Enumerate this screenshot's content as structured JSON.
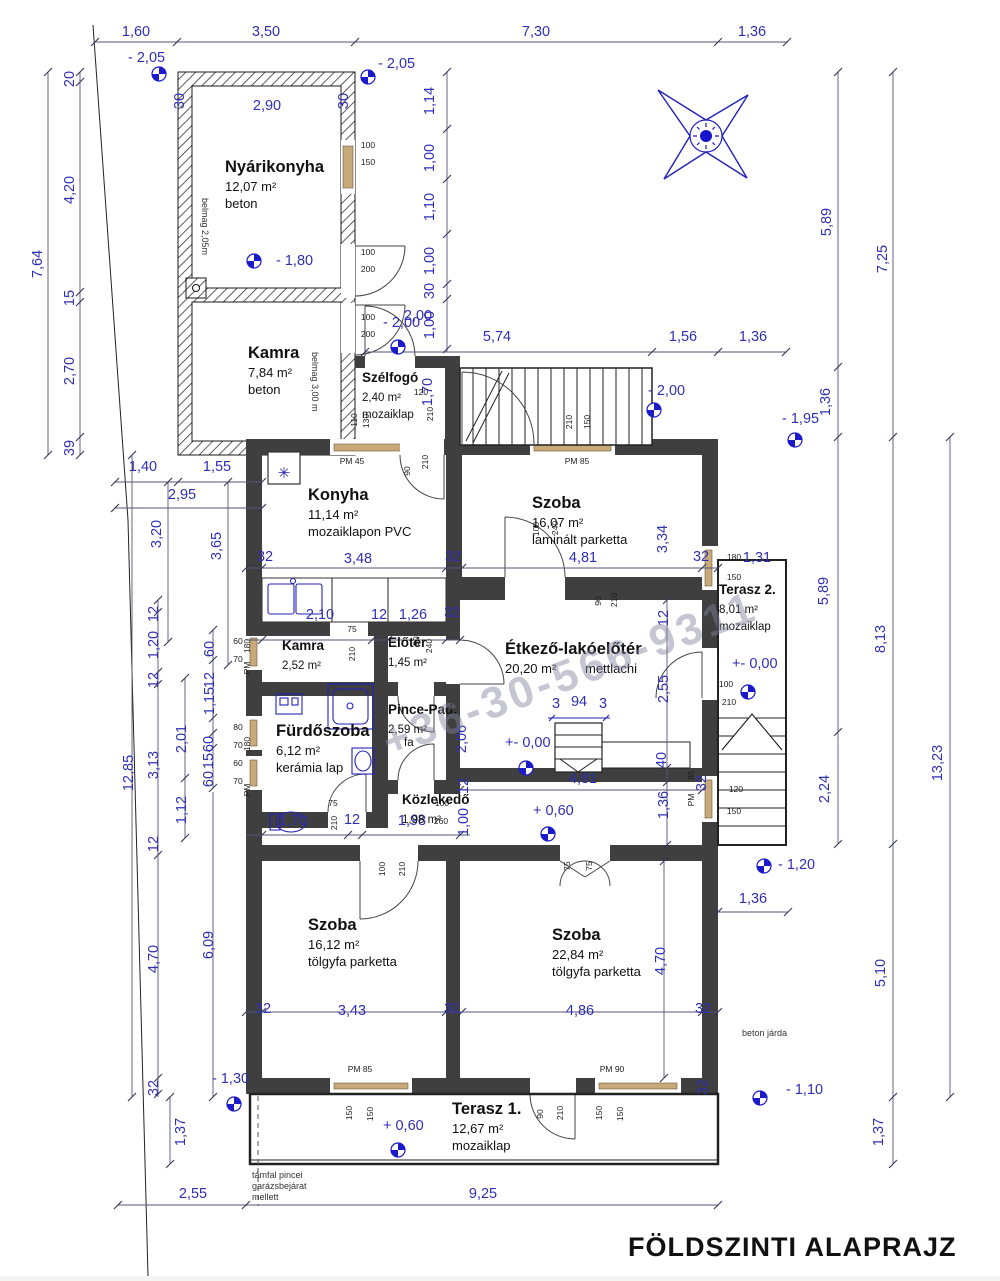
{
  "title": "FÖLDSZINTI ALAPRAJZ",
  "watermark": "+36-30-566-9311",
  "colors": {
    "dimension_text": "#2f2fb3",
    "wall_fill": "#3f3f3f",
    "window_fill": "#c8a97a",
    "fixture_blue": "#2222bb"
  },
  "rooms": [
    {
      "name": "Nyárikonyha",
      "area": "12,07 m²",
      "floor": "beton",
      "x": 225,
      "y": 172
    },
    {
      "name": "Kamra",
      "area": "7,84 m²",
      "floor": "beton",
      "x": 248,
      "y": 358
    },
    {
      "name": "Szélfogó",
      "area": "2,40 m²",
      "floor": "mozaiklap",
      "x": 362,
      "y": 382,
      "sm": 1
    },
    {
      "name": "Konyha",
      "area": "11,14 m²",
      "floor": "mozaiklapon PVC",
      "x": 308,
      "y": 500
    },
    {
      "name": "Szoba",
      "area": "16,07 m²",
      "floor": "laminált parketta",
      "x": 532,
      "y": 508
    },
    {
      "name": "Kamra",
      "area": "2,52 m²",
      "floor": "",
      "x": 282,
      "y": 650,
      "sm": 1
    },
    {
      "name": "Előtér",
      "area": "1,45 m²",
      "floor": "",
      "x": 388,
      "y": 647,
      "sm": 1
    },
    {
      "name": "Étkező-lakóelőtér",
      "area": "20,20 m²",
      "floor": "mettlachi",
      "x": 505,
      "y": 654,
      "f2": [
        585,
        673
      ]
    },
    {
      "name": "Fürdőszoba",
      "area": "6,12 m²",
      "floor": "kerámia lap",
      "x": 276,
      "y": 736
    },
    {
      "name": "Pince-Pad.",
      "area": "2,59 m²",
      "floor": "fa",
      "x": 388,
      "y": 714,
      "sm": 1,
      "f2": [
        404,
        746
      ]
    },
    {
      "name": "Közlekedő",
      "area": "1,98 m²",
      "floor": "",
      "x": 402,
      "y": 804,
      "sm": 1
    },
    {
      "name": "Szoba",
      "area": "16,12 m²",
      "floor": "tölgyfa parketta",
      "x": 308,
      "y": 930
    },
    {
      "name": "Szoba",
      "area": "22,84 m²",
      "floor": "tölgyfa parketta",
      "x": 552,
      "y": 940
    },
    {
      "name": "Terasz 1.",
      "area": "12,67 m²",
      "floor": "mozaiklap",
      "x": 452,
      "y": 1114
    },
    {
      "name": "Terasz 2.",
      "area": "8,01 m²",
      "floor": "mozaiklap",
      "x": 719,
      "y": 594,
      "sm": 1
    }
  ],
  "dims": [
    {
      "t": "1,60",
      "x": 136,
      "y": 36
    },
    {
      "t": "3,50",
      "x": 266,
      "y": 36
    },
    {
      "t": "7,30",
      "x": 536,
      "y": 36
    },
    {
      "t": "1,36",
      "x": 752,
      "y": 36
    },
    {
      "t": "7,64",
      "x": 42,
      "y": 264,
      "r": 1
    },
    {
      "t": "20",
      "x": 74,
      "y": 79,
      "r": 1
    },
    {
      "t": "4,20",
      "x": 74,
      "y": 190,
      "r": 1
    },
    {
      "t": "15",
      "x": 74,
      "y": 298,
      "r": 1
    },
    {
      "t": "2,70",
      "x": 74,
      "y": 371,
      "r": 1
    },
    {
      "t": "39",
      "x": 74,
      "y": 448,
      "r": 1
    },
    {
      "t": "2,90",
      "x": 267,
      "y": 110
    },
    {
      "t": "30",
      "x": 184,
      "y": 101,
      "r": 1
    },
    {
      "t": "30",
      "x": 348,
      "y": 101,
      "r": 1
    },
    {
      "t": "1,14",
      "x": 434,
      "y": 101,
      "r": 1
    },
    {
      "t": "1,00",
      "x": 434,
      "y": 158,
      "r": 1
    },
    {
      "t": "1,10",
      "x": 434,
      "y": 207,
      "r": 1
    },
    {
      "t": "1,00",
      "x": 434,
      "y": 261,
      "r": 1
    },
    {
      "t": "30",
      "x": 434,
      "y": 291,
      "r": 1
    },
    {
      "t": "1,00",
      "x": 434,
      "y": 325,
      "r": 1
    },
    {
      "t": "1,70",
      "x": 432,
      "y": 392,
      "r": 1
    },
    {
      "t": "2,00",
      "x": 418,
      "y": 320
    },
    {
      "t": "5,74",
      "x": 497,
      "y": 341
    },
    {
      "t": "1,56",
      "x": 683,
      "y": 341
    },
    {
      "t": "1,36",
      "x": 753,
      "y": 341
    },
    {
      "t": "1,40",
      "x": 143,
      "y": 471
    },
    {
      "t": "1,55",
      "x": 217,
      "y": 471
    },
    {
      "t": "2,95",
      "x": 182,
      "y": 499
    },
    {
      "t": "3,20",
      "x": 161,
      "y": 534,
      "r": 1
    },
    {
      "t": "3,65",
      "x": 221,
      "y": 546,
      "r": 1
    },
    {
      "t": "32",
      "x": 265,
      "y": 561
    },
    {
      "t": "3,48",
      "x": 358,
      "y": 563
    },
    {
      "t": "32",
      "x": 453,
      "y": 561
    },
    {
      "t": "4,81",
      "x": 583,
      "y": 562
    },
    {
      "t": "32",
      "x": 701,
      "y": 561
    },
    {
      "t": "3,34",
      "x": 667,
      "y": 539,
      "r": 1
    },
    {
      "t": "1,31",
      "x": 757,
      "y": 562
    },
    {
      "t": "5,89",
      "x": 831,
      "y": 222,
      "r": 1
    },
    {
      "t": "7,25",
      "x": 887,
      "y": 259,
      "r": 1
    },
    {
      "t": "1,36",
      "x": 830,
      "y": 402,
      "r": 1
    },
    {
      "t": "5,89",
      "x": 828,
      "y": 591,
      "r": 1
    },
    {
      "t": "8,13",
      "x": 885,
      "y": 639,
      "r": 1
    },
    {
      "t": "13,23",
      "x": 942,
      "y": 763,
      "r": 1
    },
    {
      "t": "2,24",
      "x": 829,
      "y": 789,
      "r": 1
    },
    {
      "t": "5,10",
      "x": 885,
      "y": 973,
      "r": 1
    },
    {
      "t": "1,37",
      "x": 883,
      "y": 1132,
      "r": 1
    },
    {
      "t": "2,10",
      "x": 320,
      "y": 619
    },
    {
      "t": "12",
      "x": 379,
      "y": 619
    },
    {
      "t": "1,26",
      "x": 413,
      "y": 619
    },
    {
      "t": "32",
      "x": 452,
      "y": 617
    },
    {
      "t": "2,55",
      "x": 668,
      "y": 689,
      "r": 1
    },
    {
      "t": "3",
      "x": 556,
      "y": 708
    },
    {
      "t": "94",
      "x": 579,
      "y": 706
    },
    {
      "t": "3",
      "x": 603,
      "y": 708
    },
    {
      "t": "4,81",
      "x": 583,
      "y": 783
    },
    {
      "t": "40",
      "x": 666,
      "y": 760,
      "r": 1
    },
    {
      "t": "1,36",
      "x": 668,
      "y": 805,
      "r": 1
    },
    {
      "t": "1,70",
      "x": 293,
      "y": 825
    },
    {
      "t": "12",
      "x": 352,
      "y": 824
    },
    {
      "t": "1,98",
      "x": 412,
      "y": 825
    },
    {
      "t": "12",
      "x": 158,
      "y": 614,
      "r": 1
    },
    {
      "t": "1,20",
      "x": 158,
      "y": 645,
      "r": 1
    },
    {
      "t": "12",
      "x": 158,
      "y": 680,
      "r": 1
    },
    {
      "t": "60",
      "x": 214,
      "y": 649,
      "r": 1
    },
    {
      "t": "1,15",
      "x": 214,
      "y": 701,
      "r": 1
    },
    {
      "t": "12",
      "x": 214,
      "y": 680,
      "r": 1
    },
    {
      "t": "2,01",
      "x": 186,
      "y": 739,
      "r": 1
    },
    {
      "t": "60",
      "x": 213,
      "y": 744,
      "r": 1
    },
    {
      "t": "15",
      "x": 213,
      "y": 761,
      "r": 1
    },
    {
      "t": "60",
      "x": 213,
      "y": 779,
      "r": 1
    },
    {
      "t": "1,12",
      "x": 186,
      "y": 810,
      "r": 1
    },
    {
      "t": "12",
      "x": 158,
      "y": 844,
      "r": 1
    },
    {
      "t": "12,85",
      "x": 133,
      "y": 773,
      "r": 1
    },
    {
      "t": "3,13",
      "x": 158,
      "y": 765,
      "r": 1
    },
    {
      "t": "2,06",
      "x": 466,
      "y": 739,
      "r": 1
    },
    {
      "t": "1,00",
      "x": 468,
      "y": 822,
      "r": 1
    },
    {
      "t": "12",
      "x": 468,
      "y": 786,
      "r": 1
    },
    {
      "t": "6,09",
      "x": 213,
      "y": 945,
      "r": 1
    },
    {
      "t": "4,70",
      "x": 158,
      "y": 959,
      "r": 1
    },
    {
      "t": "4,70",
      "x": 665,
      "y": 961,
      "r": 1
    },
    {
      "t": "32",
      "x": 158,
      "y": 1088,
      "r": 1
    },
    {
      "t": "1,37",
      "x": 185,
      "y": 1132,
      "r": 1
    },
    {
      "t": "2,55",
      "x": 193,
      "y": 1198
    },
    {
      "t": "3,43",
      "x": 352,
      "y": 1015
    },
    {
      "t": "32",
      "x": 263,
      "y": 1013
    },
    {
      "t": "32",
      "x": 452,
      "y": 1013
    },
    {
      "t": "4,86",
      "x": 580,
      "y": 1015
    },
    {
      "t": "32",
      "x": 703,
      "y": 1013
    },
    {
      "t": "9,25",
      "x": 483,
      "y": 1198
    },
    {
      "t": "1,36",
      "x": 753,
      "y": 903
    },
    {
      "t": "32",
      "x": 707,
      "y": 1087,
      "r": 1
    },
    {
      "t": "32",
      "x": 706,
      "y": 783,
      "r": 1
    },
    {
      "t": "12",
      "x": 668,
      "y": 618,
      "r": 1
    }
  ],
  "small_labels": [
    {
      "t": "100",
      "x": 368,
      "y": 148
    },
    {
      "t": "150",
      "x": 368,
      "y": 165
    },
    {
      "t": "100",
      "x": 368,
      "y": 255
    },
    {
      "t": "200",
      "x": 368,
      "y": 272
    },
    {
      "t": "100",
      "x": 368,
      "y": 320
    },
    {
      "t": "200",
      "x": 368,
      "y": 337
    },
    {
      "t": "PM  45",
      "x": 352,
      "y": 464
    },
    {
      "t": "PM  85",
      "x": 577,
      "y": 464
    },
    {
      "t": "210",
      "x": 572,
      "y": 422,
      "r": 1
    },
    {
      "t": "150",
      "x": 590,
      "y": 422,
      "r": 1
    },
    {
      "t": "120",
      "x": 421,
      "y": 395
    },
    {
      "t": "210",
      "x": 433,
      "y": 414,
      "r": 1
    },
    {
      "t": "110",
      "x": 357,
      "y": 420,
      "r": 1
    },
    {
      "t": "130",
      "x": 369,
      "y": 421,
      "r": 1
    },
    {
      "t": "90",
      "x": 410,
      "y": 471,
      "r": 1
    },
    {
      "t": "210",
      "x": 428,
      "y": 462,
      "r": 1
    },
    {
      "t": "100",
      "x": 539,
      "y": 529,
      "r": 1
    },
    {
      "t": "240",
      "x": 558,
      "y": 528,
      "r": 1
    },
    {
      "t": "75",
      "x": 352,
      "y": 632
    },
    {
      "t": "210",
      "x": 355,
      "y": 654,
      "r": 1
    },
    {
      "t": "90",
      "x": 419,
      "y": 641,
      "r": 1
    },
    {
      "t": "240",
      "x": 432,
      "y": 646,
      "r": 1
    },
    {
      "t": "60",
      "x": 238,
      "y": 644
    },
    {
      "t": "70",
      "x": 238,
      "y": 662
    },
    {
      "t": "80",
      "x": 238,
      "y": 730
    },
    {
      "t": "70",
      "x": 238,
      "y": 748
    },
    {
      "t": "60",
      "x": 238,
      "y": 766
    },
    {
      "t": "70",
      "x": 238,
      "y": 784
    },
    {
      "t": "180",
      "x": 250,
      "y": 646,
      "r": 1
    },
    {
      "t": "PM",
      "x": 250,
      "y": 668,
      "r": 1
    },
    {
      "t": "180",
      "x": 250,
      "y": 744,
      "r": 1
    },
    {
      "t": "PM",
      "x": 250,
      "y": 790,
      "r": 1
    },
    {
      "t": "75",
      "x": 333,
      "y": 806
    },
    {
      "t": "210",
      "x": 337,
      "y": 823,
      "r": 1
    },
    {
      "t": "100",
      "x": 442,
      "y": 806
    },
    {
      "t": "260",
      "x": 441,
      "y": 824
    },
    {
      "t": "90",
      "x": 601,
      "y": 601,
      "r": 1
    },
    {
      "t": "210",
      "x": 617,
      "y": 600,
      "r": 1
    },
    {
      "t": "100",
      "x": 726,
      "y": 687
    },
    {
      "t": "210",
      "x": 729,
      "y": 705
    },
    {
      "t": "180",
      "x": 734,
      "y": 560
    },
    {
      "t": "150",
      "x": 734,
      "y": 580
    },
    {
      "t": "120",
      "x": 736,
      "y": 792
    },
    {
      "t": "150",
      "x": 734,
      "y": 814
    },
    {
      "t": "85",
      "x": 694,
      "y": 775,
      "r": 1
    },
    {
      "t": "PM",
      "x": 694,
      "y": 800,
      "r": 1
    },
    {
      "t": "PM  85",
      "x": 360,
      "y": 1072
    },
    {
      "t": "PM  90",
      "x": 612,
      "y": 1072
    },
    {
      "t": "150",
      "x": 352,
      "y": 1113,
      "r": 1
    },
    {
      "t": "150",
      "x": 373,
      "y": 1114,
      "r": 1
    },
    {
      "t": "90",
      "x": 543,
      "y": 1114,
      "r": 1
    },
    {
      "t": "210",
      "x": 563,
      "y": 1113,
      "r": 1
    },
    {
      "t": "150",
      "x": 602,
      "y": 1113,
      "r": 1
    },
    {
      "t": "150",
      "x": 623,
      "y": 1114,
      "r": 1
    },
    {
      "t": "100",
      "x": 385,
      "y": 869,
      "r": 1
    },
    {
      "t": "210",
      "x": 405,
      "y": 869,
      "r": 1
    },
    {
      "t": "75",
      "x": 570,
      "y": 866,
      "r": 1
    },
    {
      "t": "75",
      "x": 592,
      "y": 866,
      "r": 1
    }
  ],
  "levels": [
    {
      "t": "- 2,05",
      "x": 128,
      "y": 62,
      "sx": 159,
      "sy": 74
    },
    {
      "t": "- 2,05",
      "x": 378,
      "y": 68,
      "sx": 368,
      "sy": 77
    },
    {
      "t": "- 1,80",
      "x": 276,
      "y": 265,
      "sx": 254,
      "sy": 261
    },
    {
      "t": "- 2,00",
      "x": 383,
      "y": 327,
      "sx": 398,
      "sy": 347
    },
    {
      "t": "- 2,00",
      "x": 648,
      "y": 395,
      "sx": 654,
      "sy": 410
    },
    {
      "t": "- 1,95",
      "x": 782,
      "y": 423,
      "sx": 795,
      "sy": 440
    },
    {
      "t": "+- 0,00",
      "x": 505,
      "y": 747,
      "sx": 526,
      "sy": 768
    },
    {
      "t": "+- 0,00",
      "x": 732,
      "y": 668,
      "sx": 748,
      "sy": 692
    },
    {
      "t": "+ 0,60",
      "x": 533,
      "y": 815,
      "sx": 548,
      "sy": 834
    },
    {
      "t": "- 1,20",
      "x": 778,
      "y": 869,
      "sx": 764,
      "sy": 866
    },
    {
      "t": "- 1,30",
      "x": 212,
      "y": 1083,
      "sx": 234,
      "sy": 1104
    },
    {
      "t": "+ 0,60",
      "x": 383,
      "y": 1130,
      "sx": 398,
      "sy": 1150
    },
    {
      "t": "- 1,10",
      "x": 786,
      "y": 1094,
      "sx": 760,
      "sy": 1098
    }
  ],
  "notes": [
    {
      "t": "belmag 2,05m",
      "x": 202,
      "y": 198,
      "r": 1
    },
    {
      "t": "belmag 3,00 m",
      "x": 312,
      "y": 352,
      "r": 1
    },
    {
      "t": "támfal pincei",
      "x": 252,
      "y": 1178
    },
    {
      "t": "garázsbejárat",
      "x": 252,
      "y": 1189
    },
    {
      "t": "mellett",
      "x": 252,
      "y": 1200
    },
    {
      "t": "beton járda",
      "x": 742,
      "y": 1036
    },
    {
      "t": "✳",
      "x": 284,
      "y": 478,
      "star": 1
    }
  ]
}
